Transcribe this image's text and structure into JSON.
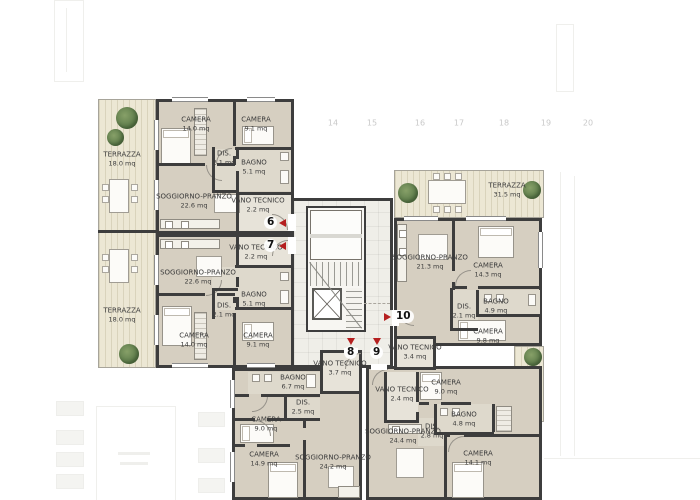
{
  "plan": {
    "type": "residential-floor-plan",
    "grid_labels": [
      "14",
      "15",
      "16",
      "17",
      "18",
      "19",
      "20"
    ],
    "colors": {
      "wall": "#3d3d3d",
      "room_floor": "#d6cfc1",
      "service_floor": "#ded9cc",
      "terrace": "#ece7d4",
      "corridor_tile": "#efeee8",
      "tree_green": "#5e7c4b",
      "marker_red": "#b51f1f",
      "grid_text": "#c9c9c9"
    },
    "units": {
      "u6": {
        "number": "6",
        "rooms": {
          "terrazza": {
            "name": "TERRAZZA",
            "area": "18.0 mq"
          },
          "camera1": {
            "name": "CAMERA",
            "area": "14.0 mq"
          },
          "camera2": {
            "name": "CAMERA",
            "area": "9.1 mq"
          },
          "dis": {
            "name": "DIS.",
            "area": "2.1 mq"
          },
          "bagno": {
            "name": "BAGNO",
            "area": "5.1 mq"
          },
          "soggiorno": {
            "name": "SOGGIORNO-PRANZO",
            "area": "22.6 mq"
          },
          "vano": {
            "name": "VANO TECNICO",
            "area": "2.2 mq"
          }
        }
      },
      "u7": {
        "number": "7",
        "rooms": {
          "terrazza": {
            "name": "TERRAZZA",
            "area": "18.0 mq"
          },
          "soggiorno": {
            "name": "SOGGIORNO-PRANZO",
            "area": "22.6 mq"
          },
          "vano": {
            "name": "VANO TECNICO",
            "area": "2.2 mq"
          },
          "bagno": {
            "name": "BAGNO",
            "area": "5.1 mq"
          },
          "dis": {
            "name": "DIS.",
            "area": "2.1 mq"
          },
          "camera1": {
            "name": "CAMERA",
            "area": "14.0 mq"
          },
          "camera2": {
            "name": "CAMERA",
            "area": "9.1 mq"
          }
        }
      },
      "u8": {
        "number": "8",
        "rooms": {
          "vano": {
            "name": "VANO TECNICO",
            "area": "3.7 mq"
          },
          "bagno": {
            "name": "BAGNO",
            "area": "6.7 mq"
          },
          "dis": {
            "name": "DIS.",
            "area": "2.5 mq"
          },
          "camera1": {
            "name": "CAMERA",
            "area": "9.0 mq"
          },
          "camera2": {
            "name": "CAMERA",
            "area": "14.9 mq"
          },
          "soggiorno": {
            "name": "SOGGIORNO-PRANZO",
            "area": "24.2 mq"
          }
        }
      },
      "u9": {
        "number": "9",
        "rooms": {
          "vano": {
            "name": "VANO TECNICO",
            "area": "2.4 mq"
          },
          "camera1": {
            "name": "CAMERA",
            "area": "9.0 mq"
          },
          "bagno": {
            "name": "BAGNO",
            "area": "4.8 mq"
          },
          "dis": {
            "name": "DIS.",
            "area": "2.8 mq"
          },
          "soggiorno": {
            "name": "SOGGIORNO-PRANZO",
            "area": "24.4 mq"
          },
          "camera2": {
            "name": "CAMERA",
            "area": "14.1 mq"
          }
        }
      },
      "u10": {
        "number": "10",
        "rooms": {
          "terrazza": {
            "name": "TERRAZZA",
            "area": "31.5 mq"
          },
          "soggiorno": {
            "name": "SOGGIORNO-PRANZO",
            "area": "21.3 mq"
          },
          "camera1": {
            "name": "CAMERA",
            "area": "14.3 mq"
          },
          "dis": {
            "name": "DIS.",
            "area": "2.1 mq"
          },
          "bagno": {
            "name": "BAGNO",
            "area": "4.9 mq"
          },
          "camera2": {
            "name": "CAMERA",
            "area": "9.8 mq"
          },
          "vano": {
            "name": "VANO TECNICO",
            "area": "3.4 mq"
          }
        }
      }
    }
  }
}
